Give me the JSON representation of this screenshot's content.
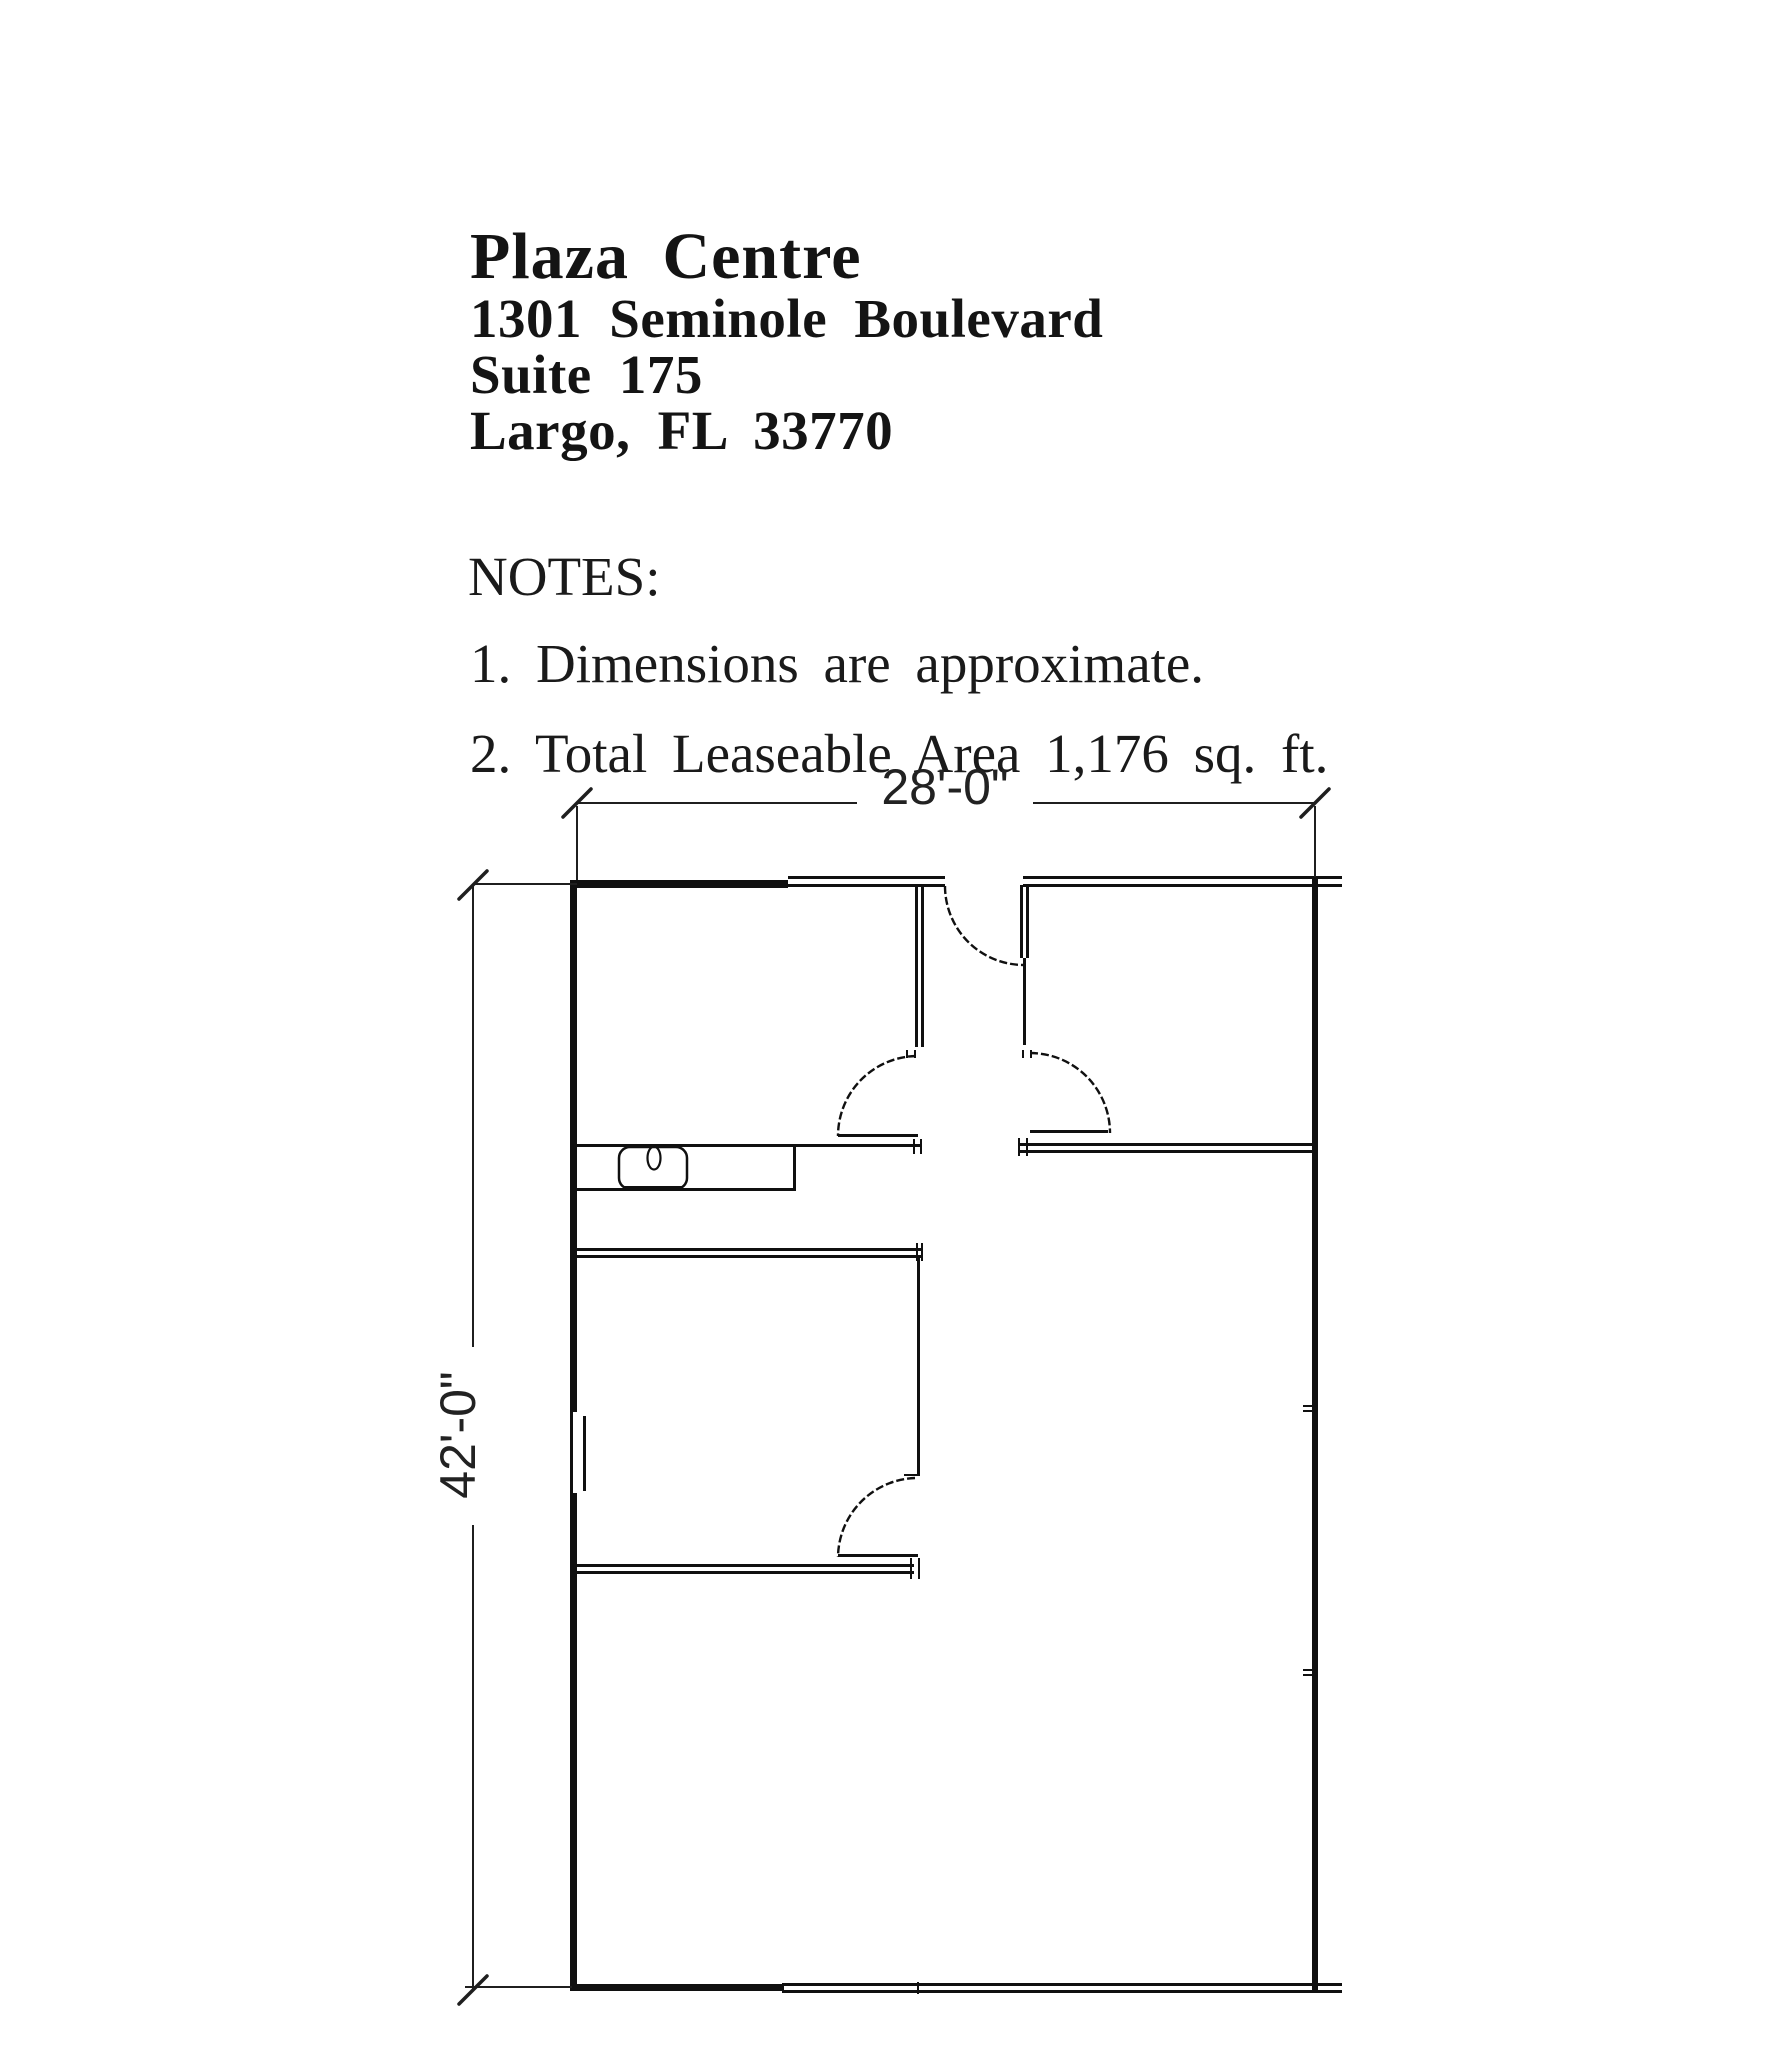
{
  "header": {
    "building": "Plaza Centre",
    "address_line": "1301 Seminole Boulevard",
    "suite_line": "Suite 175",
    "city_line": "Largo, FL 33770"
  },
  "notes": {
    "heading": "NOTES:",
    "items": [
      "1. Dimensions are approximate.",
      "2. Total Leaseable Area 1,176 sq. ft."
    ]
  },
  "dimensions": {
    "width_label": "28'-0\"",
    "height_label": "42'-0\""
  },
  "colors": {
    "ink": "#101010",
    "dim": "#1f1f1f",
    "text": "#141414",
    "background": "#ffffff"
  },
  "plan": {
    "walls": [
      {
        "name": "left-wall-upper",
        "x": 570,
        "y": 884,
        "w": 7,
        "h": 528
      },
      {
        "name": "left-wall-lower",
        "x": 570,
        "y": 1493,
        "w": 7,
        "h": 495
      },
      {
        "name": "top-wall-thick-segment",
        "x": 570,
        "y": 880,
        "w": 218,
        "h": 8
      },
      {
        "name": "bottom-wall-thick-segment",
        "x": 570,
        "y": 1984,
        "w": 214,
        "h": 7
      },
      {
        "name": "right-wall",
        "x": 1312,
        "y": 877,
        "w": 6,
        "h": 1113
      },
      {
        "name": "top-wall-outer-left",
        "x": 788,
        "y": 876,
        "w": 157,
        "h": 3
      },
      {
        "name": "top-wall-inner-left",
        "x": 788,
        "y": 884,
        "w": 157,
        "h": 3
      },
      {
        "name": "top-wall-outer-right",
        "x": 1023,
        "y": 876,
        "w": 319,
        "h": 3
      },
      {
        "name": "top-wall-inner-right",
        "x": 1023,
        "y": 884,
        "w": 319,
        "h": 3
      },
      {
        "name": "bottom-wall-outer",
        "x": 782,
        "y": 1990,
        "w": 560,
        "h": 3
      },
      {
        "name": "bottom-wall-inner",
        "x": 782,
        "y": 1983,
        "w": 560,
        "h": 3
      },
      {
        "name": "bottom-wall-joint-tick",
        "x": 917,
        "y": 1982,
        "w": 2,
        "h": 12
      },
      {
        "name": "vestibule-left-wall-line-a",
        "x": 915,
        "y": 884,
        "w": 3,
        "h": 163
      },
      {
        "name": "vestibule-left-wall-line-b",
        "x": 921,
        "y": 884,
        "w": 3,
        "h": 163
      },
      {
        "name": "entry-door-leaf-line-a",
        "x": 1020,
        "y": 885,
        "w": 3,
        "h": 73
      },
      {
        "name": "entry-door-leaf-line-b",
        "x": 1026,
        "y": 885,
        "w": 3,
        "h": 73
      },
      {
        "name": "vestibule-right-wall",
        "x": 1023,
        "y": 958,
        "w": 3,
        "h": 87
      },
      {
        "name": "hall-wall-left-segment",
        "x": 577,
        "y": 1144,
        "w": 345,
        "h": 3
      },
      {
        "name": "hall-wall-right-line-a",
        "x": 1018,
        "y": 1143,
        "w": 297,
        "h": 3
      },
      {
        "name": "hall-wall-right-line-b",
        "x": 1018,
        "y": 1150,
        "w": 297,
        "h": 3
      },
      {
        "name": "office-top-wall-line-a",
        "x": 577,
        "y": 1248,
        "w": 345,
        "h": 3
      },
      {
        "name": "office-top-wall-line-b",
        "x": 577,
        "y": 1255,
        "w": 345,
        "h": 3
      },
      {
        "name": "office-right-wall",
        "x": 917,
        "y": 1258,
        "w": 3,
        "h": 218
      },
      {
        "name": "office-bottom-wall-line-a",
        "x": 577,
        "y": 1564,
        "w": 337,
        "h": 3
      },
      {
        "name": "office-bottom-wall-line-b",
        "x": 577,
        "y": 1571,
        "w": 337,
        "h": 3
      },
      {
        "name": "counter-bottom-edge",
        "x": 577,
        "y": 1188,
        "w": 219,
        "h": 3
      },
      {
        "name": "counter-right-edge",
        "x": 793,
        "y": 1147,
        "w": 3,
        "h": 44
      },
      {
        "name": "left-door-leaf",
        "x": 838,
        "y": 1134,
        "w": 80,
        "h": 3
      },
      {
        "name": "right-door-leaf",
        "x": 1030,
        "y": 1130,
        "w": 78,
        "h": 3
      },
      {
        "name": "office-door-leaf",
        "x": 838,
        "y": 1554,
        "w": 80,
        "h": 3
      },
      {
        "name": "window-outer-line",
        "x": 570,
        "y": 1412,
        "w": 3,
        "h": 81
      },
      {
        "name": "window-inner-line",
        "x": 583,
        "y": 1416,
        "w": 3,
        "h": 75
      },
      {
        "name": "sink-bottom-edge",
        "x": 624,
        "y": 1186,
        "w": 58,
        "h": 5
      },
      {
        "name": "hall-left-jamb-tick-a",
        "x": 913,
        "y": 1139,
        "w": 2,
        "h": 15
      },
      {
        "name": "hall-left-jamb-tick-b",
        "x": 920,
        "y": 1139,
        "w": 2,
        "h": 15
      },
      {
        "name": "hall-right-jamb-tick-a",
        "x": 1018,
        "y": 1138,
        "w": 2,
        "h": 18
      },
      {
        "name": "hall-right-jamb-tick-b",
        "x": 1026,
        "y": 1138,
        "w": 2,
        "h": 18
      },
      {
        "name": "vestibule-left-door-jamb-tick-a",
        "x": 906,
        "y": 1050,
        "w": 2,
        "h": 8
      },
      {
        "name": "vestibule-left-door-jamb-tick-b",
        "x": 914,
        "y": 1050,
        "w": 2,
        "h": 8
      },
      {
        "name": "vestibule-right-door-jamb-tick-a",
        "x": 1022,
        "y": 1050,
        "w": 2,
        "h": 8
      },
      {
        "name": "vestibule-right-door-jamb-tick-b",
        "x": 1030,
        "y": 1050,
        "w": 2,
        "h": 8
      },
      {
        "name": "office-top-jamb-tick-a",
        "x": 916,
        "y": 1243,
        "w": 2,
        "h": 18
      },
      {
        "name": "office-top-jamb-tick-b",
        "x": 921,
        "y": 1243,
        "w": 2,
        "h": 18
      },
      {
        "name": "office-door-top-jamb-tick",
        "x": 904,
        "y": 1474,
        "w": 13,
        "h": 2
      },
      {
        "name": "office-bottom-jamb-tick-a",
        "x": 910,
        "y": 1558,
        "w": 2,
        "h": 21
      },
      {
        "name": "office-bottom-jamb-tick-b",
        "x": 918,
        "y": 1558,
        "w": 2,
        "h": 21
      },
      {
        "name": "right-wall-joint-tick-1a",
        "x": 1303,
        "y": 1405,
        "w": 9,
        "h": 2
      },
      {
        "name": "right-wall-joint-tick-1b",
        "x": 1303,
        "y": 1410,
        "w": 9,
        "h": 2
      },
      {
        "name": "right-wall-joint-tick-2a",
        "x": 1303,
        "y": 1669,
        "w": 9,
        "h": 2
      },
      {
        "name": "right-wall-joint-tick-2b",
        "x": 1303,
        "y": 1674,
        "w": 9,
        "h": 2
      }
    ],
    "dim_lines": [
      {
        "name": "width-dim-line-left",
        "x": 577,
        "y": 802,
        "w": 280,
        "h": 2
      },
      {
        "name": "width-dim-line-right",
        "x": 1033,
        "y": 802,
        "w": 282,
        "h": 2
      },
      {
        "name": "width-ext-line-left",
        "x": 576,
        "y": 806,
        "w": 2,
        "h": 74
      },
      {
        "name": "width-ext-line-right",
        "x": 1314,
        "y": 806,
        "w": 2,
        "h": 71
      },
      {
        "name": "height-dim-line-upper",
        "x": 472,
        "y": 885,
        "w": 2,
        "h": 462
      },
      {
        "name": "height-dim-line-lower",
        "x": 472,
        "y": 1525,
        "w": 2,
        "h": 465
      },
      {
        "name": "height-ext-line-top",
        "x": 473,
        "y": 883,
        "w": 104,
        "h": 2
      },
      {
        "name": "height-ext-line-bottom",
        "x": 465,
        "y": 1986,
        "w": 107,
        "h": 2
      }
    ],
    "arcs": [
      {
        "name": "entry-door-swing-arc",
        "d": "M 945,886 A 79,79 0 0 0 1024,965",
        "w": 2.4,
        "dash": "8 3"
      },
      {
        "name": "left-door-swing-arc",
        "d": "M 916,1056 A 80,80 0 0 0 838,1136",
        "w": 2.4,
        "dash": "8 3"
      },
      {
        "name": "right-door-swing-arc",
        "d": "M 1030,1053 A 80,80 0 0 1 1110,1133",
        "w": 2.4,
        "dash": "8 3"
      },
      {
        "name": "office-door-swing-arc",
        "d": "M 915,1478 A 80,80 0 0 0 838,1557",
        "w": 2.4,
        "dash": "8 3"
      }
    ],
    "dim_ticks": [
      {
        "name": "width-dim-tick-left",
        "d": "M 563,817 L 591,789",
        "w": 3.5
      },
      {
        "name": "width-dim-tick-right",
        "d": "M 1301,817 L 1329,789",
        "w": 3.5
      },
      {
        "name": "height-dim-tick-top",
        "d": "M 459,899 L 487,871",
        "w": 3.5
      },
      {
        "name": "height-dim-tick-bottom",
        "d": "M 459,2004 L 487,1976",
        "w": 3.5
      }
    ],
    "fixtures": {
      "outline_rects": [
        {
          "name": "sink-basin",
          "x": 619,
          "y": 1147,
          "w": 68,
          "h": 42,
          "r": 11,
          "stroke": 2.5
        }
      ],
      "ellipses": [
        {
          "name": "faucet",
          "cx": 654,
          "cy": 1158,
          "rx": 6.5,
          "ry": 11.5,
          "stroke": 2.2
        }
      ]
    }
  }
}
